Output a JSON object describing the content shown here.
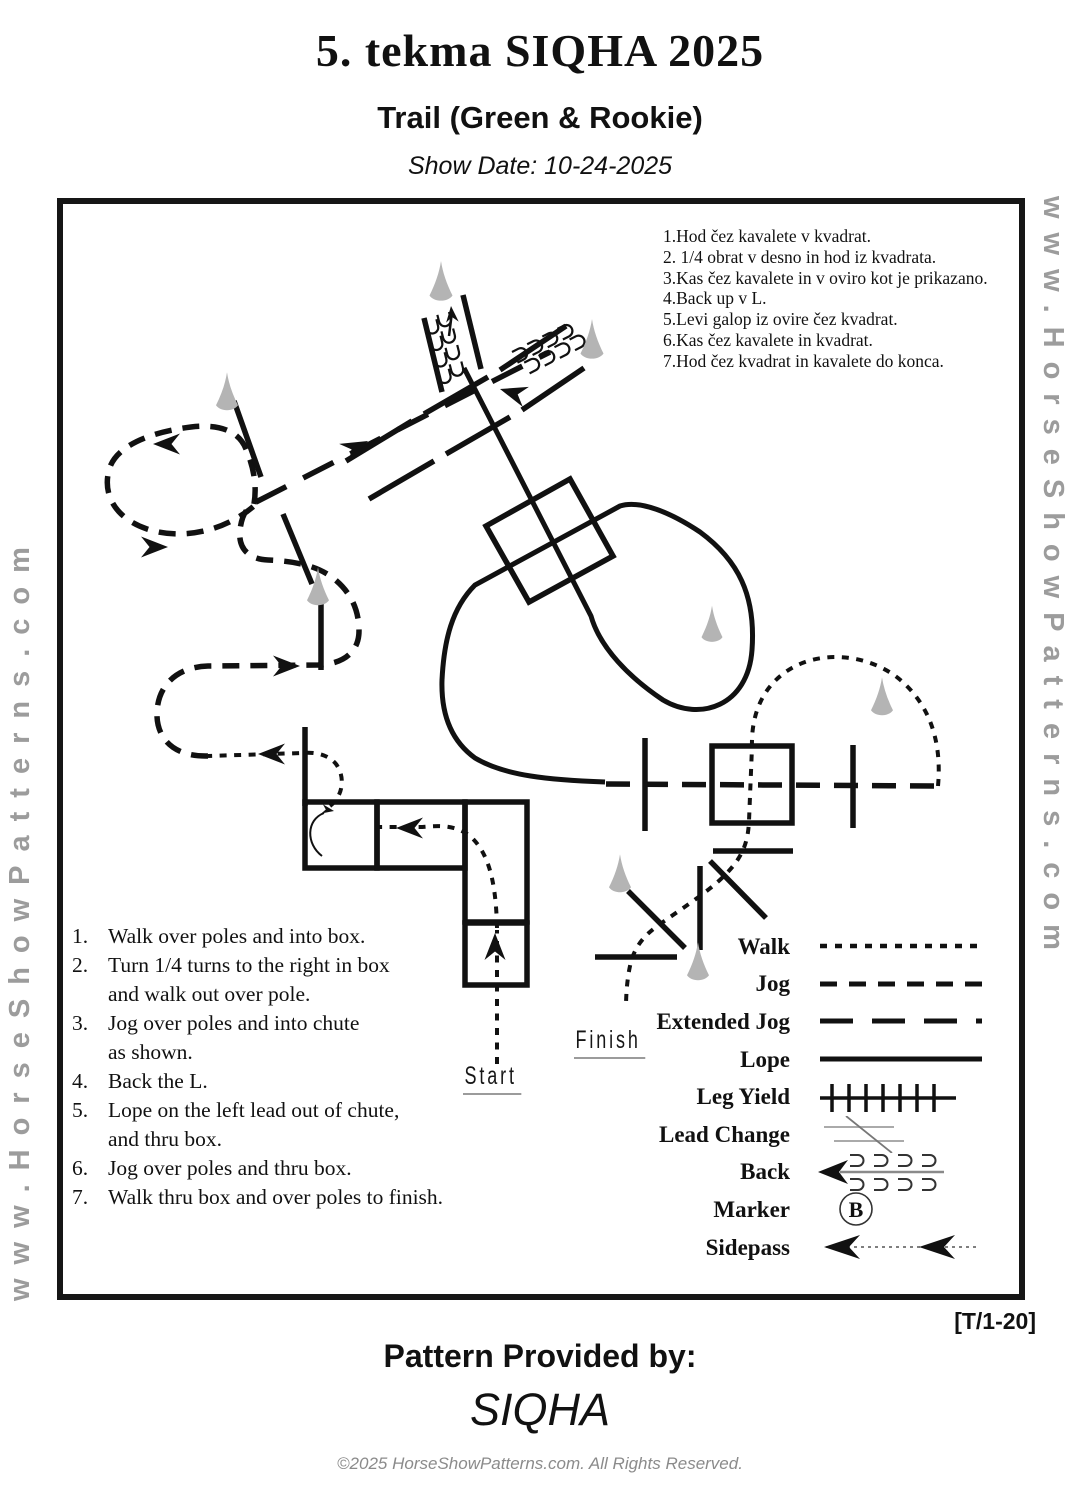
{
  "header": {
    "title": "5. tekma SIQHA 2025",
    "subtitle": "Trail (Green & Rookie)",
    "show_date": "Show Date: 10-24-2025"
  },
  "watermark": {
    "text": "www.HorseShowPatterns.com"
  },
  "instructions_sl": [
    "1.Hod čez kavalete v kvadrat.",
    "2. 1/4 obrat v desno in hod iz kvadrata.",
    "3.Kas čez kavalete in v oviro kot je prikazano.",
    "4.Back up v L.",
    "5.Levi galop iz ovire čez kvadrat.",
    "6.Kas čez kavalete in kvadrat.",
    "7.Hod čez kvadrat in kavalete do konca."
  ],
  "instructions_en": [
    {
      "num": "1.",
      "lines": [
        "Walk over poles and into box."
      ]
    },
    {
      "num": "2.",
      "lines": [
        "Turn 1/4 turns to the right in box",
        "and walk out over pole."
      ]
    },
    {
      "num": "3.",
      "lines": [
        "Jog over poles and into chute",
        "as shown."
      ]
    },
    {
      "num": "4.",
      "lines": [
        "Back the L."
      ]
    },
    {
      "num": "5.",
      "lines": [
        "Lope on the left lead out of  chute,",
        "and thru box."
      ]
    },
    {
      "num": "6.",
      "lines": [
        "Jog over poles and thru box."
      ]
    },
    {
      "num": "7.",
      "lines": [
        "Walk thru box and over poles to finish."
      ]
    }
  ],
  "diagram": {
    "start_label": "Start",
    "finish_label": "Finish"
  },
  "legend": {
    "items": [
      {
        "label": "Walk"
      },
      {
        "label": "Jog"
      },
      {
        "label": "Extended Jog"
      },
      {
        "label": "Lope"
      },
      {
        "label": "Leg Yield"
      },
      {
        "label": "Lead Change"
      },
      {
        "label": "Back"
      },
      {
        "label": "Marker"
      },
      {
        "label": "Sidepass"
      }
    ],
    "marker_letter": "B"
  },
  "footer": {
    "pattern_code": "[T/1-20]",
    "provided_by": "Pattern Provided by:",
    "provider": "SIQHA",
    "copyright": "©2025 HorseShowPatterns.com. All Rights Reserved."
  },
  "colors": {
    "ink": "#111111",
    "watermark_gray": "#9c9c9c",
    "cone_gray": "#b4b4b4",
    "copyright_gray": "#8b8b8b"
  }
}
